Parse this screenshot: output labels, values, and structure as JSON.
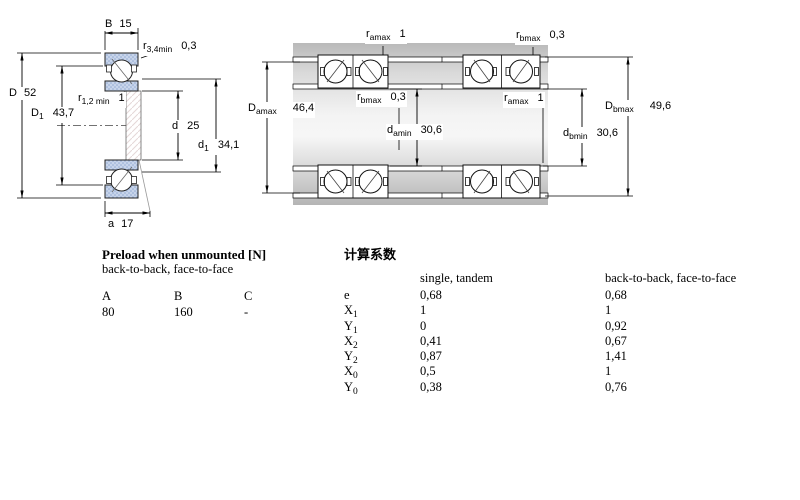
{
  "diagrams": {
    "left": {
      "labels": {
        "B": {
          "base": "B",
          "value": "15"
        },
        "r34": {
          "base": "r",
          "sub": "3,4min",
          "value": "0,3"
        },
        "D": {
          "base": "D",
          "value": "52"
        },
        "D1": {
          "base": "D",
          "sub": "1",
          "value": "43,7"
        },
        "r12": {
          "base": "r",
          "sub": "1,2 min",
          "value": "1"
        },
        "d": {
          "base": "d",
          "value": "25"
        },
        "d1": {
          "base": "d",
          "sub": "1",
          "value": "34,1"
        },
        "a": {
          "base": "a",
          "value": "17"
        }
      }
    },
    "middle": {
      "labels": {
        "ramax": {
          "base": "r",
          "sub": "amax",
          "value": "1"
        },
        "rbmax": {
          "base": "r",
          "sub": "bmax",
          "value": "0,3"
        },
        "Damax": {
          "base": "D",
          "sub": "amax",
          "value": "46,4"
        },
        "damin": {
          "base": "d",
          "sub": "amin",
          "value": "30,6"
        }
      }
    },
    "right": {
      "labels": {
        "rbmax": {
          "base": "r",
          "sub": "bmax",
          "value": "0,3"
        },
        "ramax": {
          "base": "r",
          "sub": "amax",
          "value": "1"
        },
        "Dbmax": {
          "base": "D",
          "sub": "bmax",
          "value": "49,6"
        },
        "dbmin": {
          "base": "d",
          "sub": "bmin",
          "value": "30,6"
        }
      }
    }
  },
  "preload": {
    "title": "Preload when unmounted [N]",
    "subtitle": "back-to-back, face-to-face",
    "columns": [
      "A",
      "B",
      "C"
    ],
    "values": [
      "80",
      "160",
      "-"
    ]
  },
  "factors": {
    "title": "计算系数",
    "col1_header": "single, tandem",
    "col2_header": "back-to-back, face-to-face",
    "rows": [
      {
        "base": "e",
        "sub": "",
        "v1": "0,68",
        "v2": "0,68"
      },
      {
        "base": "X",
        "sub": "1",
        "v1": "1",
        "v2": "1"
      },
      {
        "base": "Y",
        "sub": "1",
        "v1": "0",
        "v2": "0,92"
      },
      {
        "base": "X",
        "sub": "2",
        "v1": "0,41",
        "v2": "0,67"
      },
      {
        "base": "Y",
        "sub": "2",
        "v1": "0,87",
        "v2": "1,41"
      },
      {
        "base": "X",
        "sub": "0",
        "v1": "0,5",
        "v2": "1"
      },
      {
        "base": "Y",
        "sub": "0",
        "v1": "0,38",
        "v2": "0,76"
      }
    ]
  },
  "colors": {
    "ring_fill": "#c7d4ea",
    "ring_dot": "#92abd3",
    "steel_dark": "#b9b9b9",
    "steel_light": "#f4f4f4",
    "line": "#000000"
  }
}
